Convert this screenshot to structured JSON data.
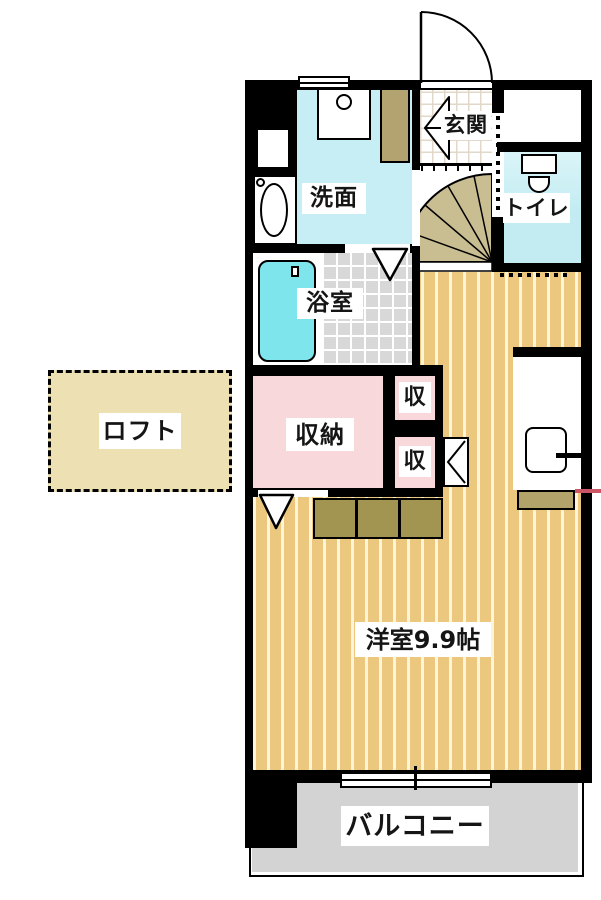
{
  "floorplan": {
    "rooms": {
      "entrance": {
        "label": "玄関"
      },
      "toilet": {
        "label": "トイレ"
      },
      "washroom": {
        "label": "洗面"
      },
      "bathroom": {
        "label": "浴室"
      },
      "storage": {
        "label": "収納"
      },
      "storage_small_top": {
        "label": "収"
      },
      "storage_small_bottom": {
        "label": "収"
      },
      "loft": {
        "label": "ロフト"
      },
      "main_room": {
        "label": "洋室9.9帖"
      },
      "balcony": {
        "label": "バルコニー"
      }
    },
    "colors": {
      "wall": "#000000",
      "wood_floor": "#ecc87e",
      "wood_stripe": "#fdf4da",
      "wet_room_cyan": "#c6eef4",
      "bathtub_cyan": "#7fe5ec",
      "storage_pink": "#f9d8dc",
      "tile_gray": "#d8d8d8",
      "balcony_gray": "#d3d3d3",
      "loft_beige": "#ede0b2",
      "step_khaki": "#a29551",
      "cabinet_khaki": "#b2a371",
      "fan_step_khaki": "#c9bd92",
      "boundary_red": "#cc5566"
    }
  }
}
